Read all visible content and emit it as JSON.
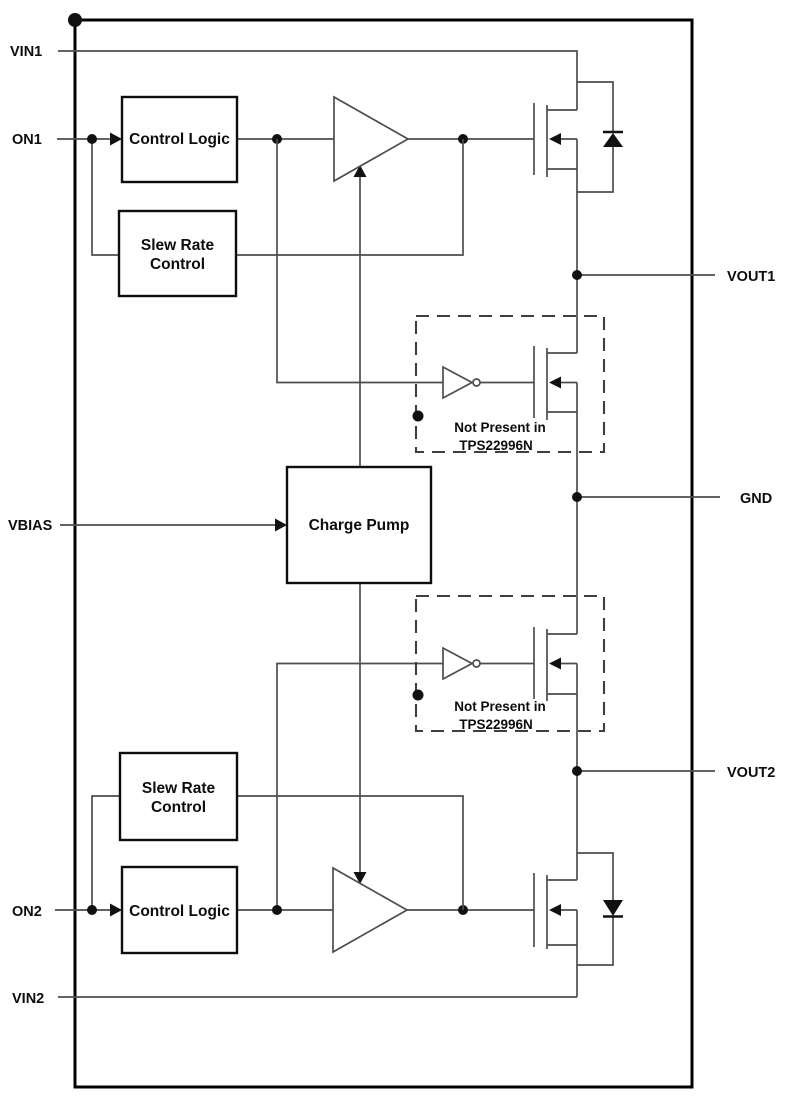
{
  "diagram": {
    "pins": {
      "vin1": "VIN1",
      "on1": "ON1",
      "vbias": "VBIAS",
      "on2": "ON2",
      "vin2": "VIN2",
      "vout1": "VOUT1",
      "gnd": "GND",
      "vout2": "VOUT2"
    },
    "blocks": {
      "control_logic": "Control Logic",
      "slew_rate_line1": "Slew Rate",
      "slew_rate_line2": "Control",
      "charge_pump": "Charge Pump"
    },
    "note": {
      "line1": "Not Present in",
      "line2": "TPS22996N"
    },
    "colors": {
      "background": "#ffffff",
      "border": "#000000",
      "wire": "#4d4d4d",
      "text": "#0d0d0d"
    }
  }
}
